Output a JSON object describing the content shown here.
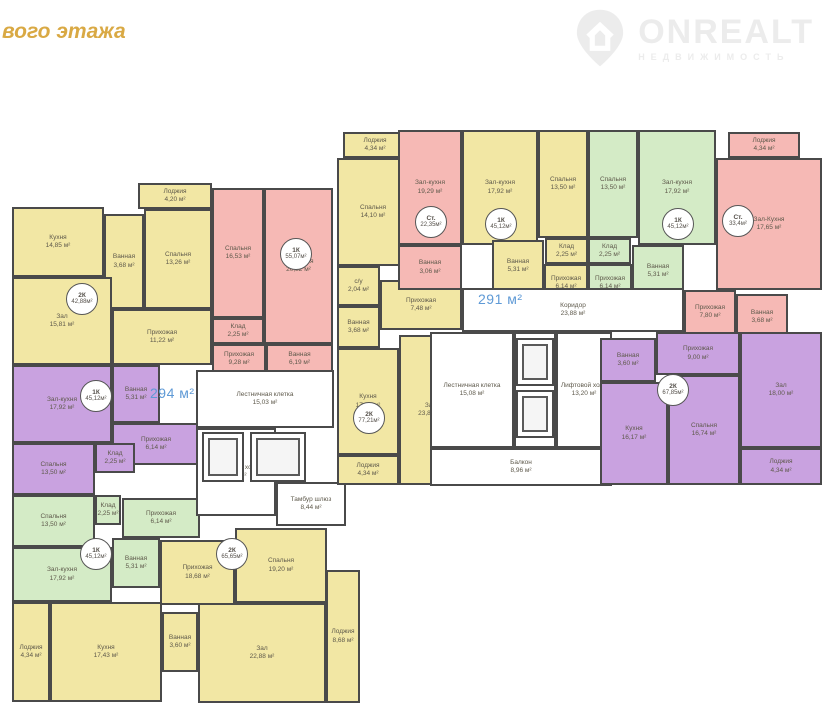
{
  "header": {
    "title_fragment": "вого этажа"
  },
  "logo": {
    "brand": "ONREALT",
    "subtitle": "НЕДВИЖИМОСТЬ",
    "icon": "house-pin-icon",
    "color": "#ececec"
  },
  "colors": {
    "yellow": "#f2e7a4",
    "pink": "#f6b9b5",
    "green": "#d4ebc6",
    "purple": "#c9a2e0",
    "white": "#ffffff",
    "wall": "#4a4a4a",
    "accent_blue": "#5f9ad6",
    "title_gold": "#d9a944"
  },
  "floorplan": {
    "sections": [
      {
        "name": "left-block",
        "area_label": {
          "text": "294 м²",
          "x": 150,
          "y": 385
        },
        "rooms": [
          {
            "label": "Лоджия",
            "area": "4,20 м²",
            "x": 138,
            "y": 183,
            "w": 74,
            "h": 26,
            "fill": "yellow"
          },
          {
            "label": "Кухня",
            "area": "14,85 м²",
            "x": 12,
            "y": 207,
            "w": 92,
            "h": 70,
            "fill": "yellow"
          },
          {
            "label": "Ванная",
            "area": "3,68 м²",
            "x": 104,
            "y": 214,
            "w": 40,
            "h": 95,
            "fill": "yellow"
          },
          {
            "label": "Спальня",
            "area": "13,26 м²",
            "x": 144,
            "y": 209,
            "w": 68,
            "h": 100,
            "fill": "yellow"
          },
          {
            "label": "Зал",
            "area": "15,81 м²",
            "x": 12,
            "y": 277,
            "w": 100,
            "h": 88,
            "fill": "yellow"
          },
          {
            "label": "Прихожая",
            "area": "11,22 м²",
            "x": 112,
            "y": 309,
            "w": 100,
            "h": 56,
            "fill": "yellow"
          },
          {
            "label": "Спальня",
            "area": "16,53 м²",
            "x": 212,
            "y": 188,
            "w": 52,
            "h": 130,
            "fill": "pink"
          },
          {
            "label": "Клад",
            "area": "2,25 м²",
            "x": 212,
            "y": 318,
            "w": 52,
            "h": 26,
            "fill": "pink"
          },
          {
            "label": "Зал-кухня",
            "area": "20,82 м²",
            "x": 264,
            "y": 188,
            "w": 69,
            "h": 156,
            "fill": "pink"
          },
          {
            "label": "Прихожая",
            "area": "9,28 м²",
            "x": 212,
            "y": 344,
            "w": 54,
            "h": 30,
            "fill": "pink"
          },
          {
            "label": "Ванная",
            "area": "6,19 м²",
            "x": 266,
            "y": 344,
            "w": 67,
            "h": 30,
            "fill": "pink"
          },
          {
            "label": "Зал-кухня",
            "area": "17,92 м²",
            "x": 12,
            "y": 365,
            "w": 100,
            "h": 78,
            "fill": "purple"
          },
          {
            "label": "Ванная",
            "area": "5,31 м²",
            "x": 112,
            "y": 365,
            "w": 48,
            "h": 58,
            "fill": "purple"
          },
          {
            "label": "Прихожая",
            "area": "6,14 м²",
            "x": 112,
            "y": 423,
            "w": 88,
            "h": 42,
            "fill": "purple"
          },
          {
            "label": "Спальня",
            "area": "13,50 м²",
            "x": 12,
            "y": 443,
            "w": 83,
            "h": 52,
            "fill": "purple"
          },
          {
            "label": "Клад",
            "area": "2,25 м²",
            "x": 95,
            "y": 443,
            "w": 40,
            "h": 30,
            "fill": "purple"
          },
          {
            "label": "Спальня",
            "area": "13,50 м²",
            "x": 12,
            "y": 495,
            "w": 83,
            "h": 52,
            "fill": "green"
          },
          {
            "label": "Клад",
            "area": "2,25 м²",
            "x": 95,
            "y": 495,
            "w": 26,
            "h": 30,
            "fill": "green"
          },
          {
            "label": "Прихожая",
            "area": "6,14 м²",
            "x": 122,
            "y": 498,
            "w": 78,
            "h": 40,
            "fill": "green"
          },
          {
            "label": "Зал-кухня",
            "area": "17,92 м²",
            "x": 12,
            "y": 547,
            "w": 100,
            "h": 55,
            "fill": "green"
          },
          {
            "label": "Ванная",
            "area": "5,31 м²",
            "x": 112,
            "y": 538,
            "w": 48,
            "h": 50,
            "fill": "green"
          },
          {
            "label": "Лоджия",
            "area": "4,34 м²",
            "x": 12,
            "y": 602,
            "w": 38,
            "h": 100,
            "fill": "yellow"
          },
          {
            "label": "Кухня",
            "area": "17,43 м²",
            "x": 50,
            "y": 602,
            "w": 112,
            "h": 100,
            "fill": "yellow"
          },
          {
            "label": "Ванная",
            "area": "3,60 м²",
            "x": 162,
            "y": 612,
            "w": 36,
            "h": 60,
            "fill": "yellow"
          },
          {
            "label": "Прихожая",
            "area": "18,68 м²",
            "x": 160,
            "y": 540,
            "w": 75,
            "h": 65,
            "fill": "yellow"
          },
          {
            "label": "Спальня",
            "area": "19,20 м²",
            "x": 235,
            "y": 528,
            "w": 92,
            "h": 75,
            "fill": "yellow"
          },
          {
            "label": "Зал",
            "area": "22,88 м²",
            "x": 198,
            "y": 603,
            "w": 128,
            "h": 100,
            "fill": "yellow"
          },
          {
            "label": "Лоджия",
            "area": "8,68 м²",
            "x": 326,
            "y": 570,
            "w": 34,
            "h": 133,
            "fill": "yellow"
          },
          {
            "label": "Лестничная клетка",
            "area": "15,03 м²",
            "x": 196,
            "y": 370,
            "w": 138,
            "h": 58,
            "fill": "white",
            "type": "stairs"
          },
          {
            "label": "Лифтовой холл",
            "area": "8,40 м²",
            "x": 196,
            "y": 428,
            "w": 80,
            "h": 88,
            "fill": "white"
          },
          {
            "label": "Тамбур шлюз",
            "area": "8,44 м²",
            "x": 276,
            "y": 482,
            "w": 70,
            "h": 44,
            "fill": "white"
          },
          {
            "x": 202,
            "y": 432,
            "w": 42,
            "h": 50,
            "fill": "white",
            "type": "elevator"
          },
          {
            "x": 250,
            "y": 432,
            "w": 56,
            "h": 50,
            "fill": "white",
            "type": "elevator"
          }
        ],
        "badges": [
          {
            "type": "2К",
            "area": "42,88м²",
            "x": 66,
            "y": 283
          },
          {
            "type": "1К",
            "area": "55,07м²",
            "x": 280,
            "y": 238
          },
          {
            "type": "1К",
            "area": "45,12м²",
            "x": 80,
            "y": 380
          },
          {
            "type": "1К",
            "area": "45,12м²",
            "x": 80,
            "y": 538
          },
          {
            "type": "2К",
            "area": "65,65м²",
            "x": 216,
            "y": 538
          }
        ]
      },
      {
        "name": "right-block",
        "area_label": {
          "text": "291 м²",
          "x": 478,
          "y": 291
        },
        "rooms": [
          {
            "label": "Лоджия",
            "area": "4,34 м²",
            "x": 343,
            "y": 132,
            "w": 64,
            "h": 26,
            "fill": "yellow"
          },
          {
            "label": "Спальня",
            "area": "14,10 м²",
            "x": 337,
            "y": 158,
            "w": 72,
            "h": 108,
            "fill": "yellow"
          },
          {
            "label": "с/у",
            "area": "2,04 м²",
            "x": 337,
            "y": 266,
            "w": 43,
            "h": 40,
            "fill": "yellow"
          },
          {
            "label": "Прихожая",
            "area": "7,48 м²",
            "x": 380,
            "y": 280,
            "w": 82,
            "h": 50,
            "fill": "yellow"
          },
          {
            "label": "Ванная",
            "area": "3,68 м²",
            "x": 337,
            "y": 306,
            "w": 43,
            "h": 42,
            "fill": "yellow"
          },
          {
            "label": "Кухня",
            "area": "17,46 м²",
            "x": 337,
            "y": 348,
            "w": 62,
            "h": 107,
            "fill": "yellow"
          },
          {
            "label": "Зал",
            "area": "23,85 м²",
            "x": 399,
            "y": 335,
            "w": 63,
            "h": 150,
            "fill": "yellow"
          },
          {
            "label": "Лоджия",
            "area": "4,34 м²",
            "x": 337,
            "y": 455,
            "w": 62,
            "h": 30,
            "fill": "yellow"
          },
          {
            "label": "Зал-кухня",
            "area": "19,29 м²",
            "x": 398,
            "y": 130,
            "w": 64,
            "h": 115,
            "fill": "pink"
          },
          {
            "label": "Ванная",
            "area": "3,06 м²",
            "x": 398,
            "y": 245,
            "w": 64,
            "h": 45,
            "fill": "pink"
          },
          {
            "label": "Зал-кухня",
            "area": "17,92 м²",
            "x": 462,
            "y": 130,
            "w": 76,
            "h": 115,
            "fill": "yellow"
          },
          {
            "label": "Спальня",
            "area": "13,50 м²",
            "x": 538,
            "y": 130,
            "w": 50,
            "h": 108,
            "fill": "yellow"
          },
          {
            "label": "Клад",
            "area": "2,25 м²",
            "x": 545,
            "y": 238,
            "w": 43,
            "h": 26,
            "fill": "yellow"
          },
          {
            "label": "Ванная",
            "area": "5,31 м²",
            "x": 492,
            "y": 240,
            "w": 52,
            "h": 52,
            "fill": "yellow"
          },
          {
            "label": "Прихожая",
            "area": "6,14 м²",
            "x": 544,
            "y": 264,
            "w": 44,
            "h": 38,
            "fill": "yellow"
          },
          {
            "label": "Спальня",
            "area": "13,50 м²",
            "x": 588,
            "y": 130,
            "w": 50,
            "h": 108,
            "fill": "green"
          },
          {
            "label": "Клад",
            "area": "2,25 м²",
            "x": 588,
            "y": 238,
            "w": 43,
            "h": 26,
            "fill": "green"
          },
          {
            "label": "Прихожая",
            "area": "6,14 м²",
            "x": 588,
            "y": 264,
            "w": 44,
            "h": 38,
            "fill": "green"
          },
          {
            "label": "Зал-кухня",
            "area": "17,92 м²",
            "x": 638,
            "y": 130,
            "w": 78,
            "h": 115,
            "fill": "green"
          },
          {
            "label": "Ванная",
            "area": "5,31 м²",
            "x": 632,
            "y": 245,
            "w": 52,
            "h": 52,
            "fill": "green"
          },
          {
            "label": "Лоджия",
            "area": "4,34 м²",
            "x": 728,
            "y": 132,
            "w": 72,
            "h": 26,
            "fill": "pink"
          },
          {
            "label": "Зал-Кухня",
            "area": "17,65 м²",
            "x": 716,
            "y": 158,
            "w": 106,
            "h": 132,
            "fill": "pink"
          },
          {
            "label": "Прихожая",
            "area": "7,80 м²",
            "x": 684,
            "y": 290,
            "w": 52,
            "h": 44,
            "fill": "pink"
          },
          {
            "label": "Ванная",
            "area": "3,68 м²",
            "x": 736,
            "y": 294,
            "w": 52,
            "h": 46,
            "fill": "pink"
          },
          {
            "label": "Коридор",
            "area": "23,88 м²",
            "x": 462,
            "y": 288,
            "w": 222,
            "h": 44,
            "fill": "white"
          },
          {
            "label": "Лестничная клетка",
            "area": "15,08 м²",
            "x": 430,
            "y": 332,
            "w": 84,
            "h": 116,
            "fill": "white",
            "type": "stairs"
          },
          {
            "x": 514,
            "y": 332,
            "w": 42,
            "h": 116,
            "fill": "white"
          },
          {
            "x": 516,
            "y": 338,
            "w": 38,
            "h": 48,
            "fill": "white",
            "type": "elevator"
          },
          {
            "x": 516,
            "y": 390,
            "w": 38,
            "h": 48,
            "fill": "white",
            "type": "elevator"
          },
          {
            "label": "Лифтовой холл",
            "area": "13,20 м²",
            "x": 556,
            "y": 332,
            "w": 56,
            "h": 116,
            "fill": "white"
          },
          {
            "label": "Балкон",
            "area": "8,96 м²",
            "x": 430,
            "y": 448,
            "w": 182,
            "h": 38,
            "fill": "white"
          },
          {
            "label": "Ванная",
            "area": "3,60 м²",
            "x": 600,
            "y": 338,
            "w": 56,
            "h": 44,
            "fill": "purple"
          },
          {
            "label": "Прихожая",
            "area": "9,00 м²",
            "x": 656,
            "y": 332,
            "w": 84,
            "h": 43,
            "fill": "purple"
          },
          {
            "label": "Кухня",
            "area": "16,17 м²",
            "x": 600,
            "y": 382,
            "w": 68,
            "h": 103,
            "fill": "purple"
          },
          {
            "label": "Спальня",
            "area": "16,74 м²",
            "x": 668,
            "y": 375,
            "w": 72,
            "h": 110,
            "fill": "purple"
          },
          {
            "label": "Зал",
            "area": "18,00 м²",
            "x": 740,
            "y": 332,
            "w": 82,
            "h": 116,
            "fill": "purple"
          },
          {
            "label": "Лоджия",
            "area": "4,34 м²",
            "x": 740,
            "y": 448,
            "w": 82,
            "h": 37,
            "fill": "purple"
          }
        ],
        "badges": [
          {
            "type": "Ст.",
            "area": "22,35м²",
            "x": 415,
            "y": 206
          },
          {
            "type": "1К",
            "area": "45,12м²",
            "x": 485,
            "y": 208
          },
          {
            "type": "1К",
            "area": "45,12м²",
            "x": 662,
            "y": 208
          },
          {
            "type": "Ст.",
            "area": "33,4м²",
            "x": 722,
            "y": 205
          },
          {
            "type": "2К",
            "area": "77,21м²",
            "x": 353,
            "y": 402
          },
          {
            "type": "2К",
            "area": "67,85м²",
            "x": 657,
            "y": 374
          }
        ]
      }
    ]
  }
}
